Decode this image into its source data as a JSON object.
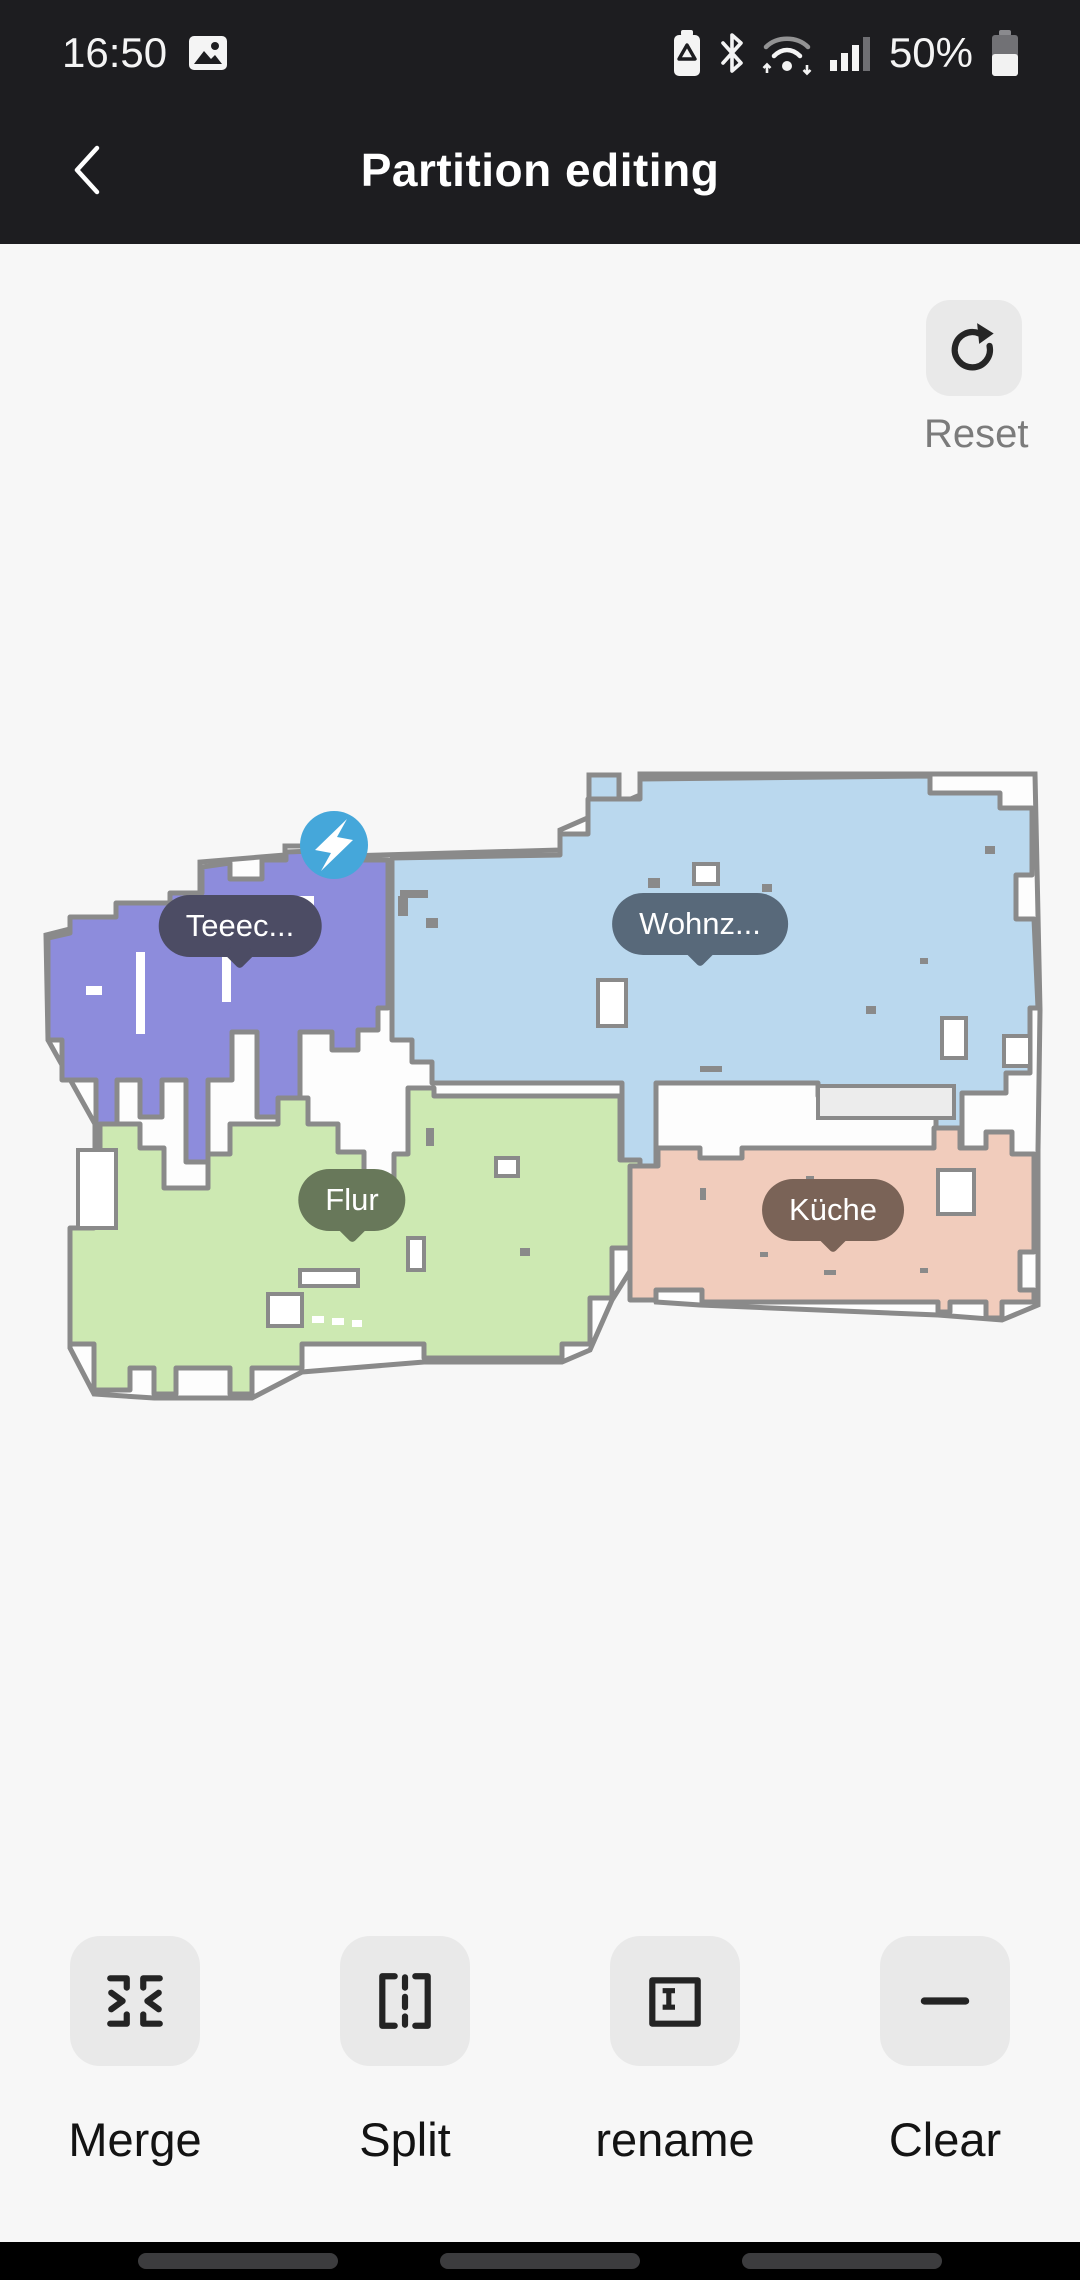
{
  "status_bar": {
    "time": "16:50",
    "battery_percent": "50%",
    "icons": [
      "image-icon",
      "battery-saver-icon",
      "bluetooth-icon",
      "wifi-icon",
      "signal-icon",
      "battery-icon"
    ]
  },
  "header": {
    "title": "Partition editing",
    "back_icon": "chevron-left-icon"
  },
  "map": {
    "reset": {
      "label": "Reset",
      "icon": "refresh-icon"
    },
    "wall_color": "#8a8a8a",
    "floor_color": "#fdfdfd",
    "unassigned_room_color": "#ececec",
    "dock": {
      "icon": "charging-dock-icon",
      "x": 334,
      "y": 845,
      "color": "#45a7da"
    },
    "rooms": [
      {
        "id": "teeec",
        "label": "Teeec...",
        "color": "#8d8cdc",
        "bubble": {
          "x": 240,
          "y": 926,
          "color": "#4c4c64"
        }
      },
      {
        "id": "wohnz",
        "label": "Wohnz...",
        "color": "#bad8ee",
        "bubble": {
          "x": 700,
          "y": 924,
          "color": "#58697a"
        }
      },
      {
        "id": "flur",
        "label": "Flur",
        "color": "#cde9b2",
        "bubble": {
          "x": 352,
          "y": 1200,
          "color": "#68785a"
        }
      },
      {
        "id": "kueche",
        "label": "Küche",
        "color": "#f1ccbc",
        "bubble": {
          "x": 833,
          "y": 1210,
          "color": "#7a6357"
        }
      }
    ]
  },
  "toolbar": {
    "items": [
      {
        "id": "merge",
        "label": "Merge",
        "icon": "merge-icon"
      },
      {
        "id": "split",
        "label": "Split",
        "icon": "split-icon"
      },
      {
        "id": "rename",
        "label": "rename",
        "icon": "rename-icon"
      },
      {
        "id": "clear",
        "label": "Clear",
        "icon": "clear-icon"
      }
    ]
  },
  "nav_bar": {
    "pills": 3
  }
}
